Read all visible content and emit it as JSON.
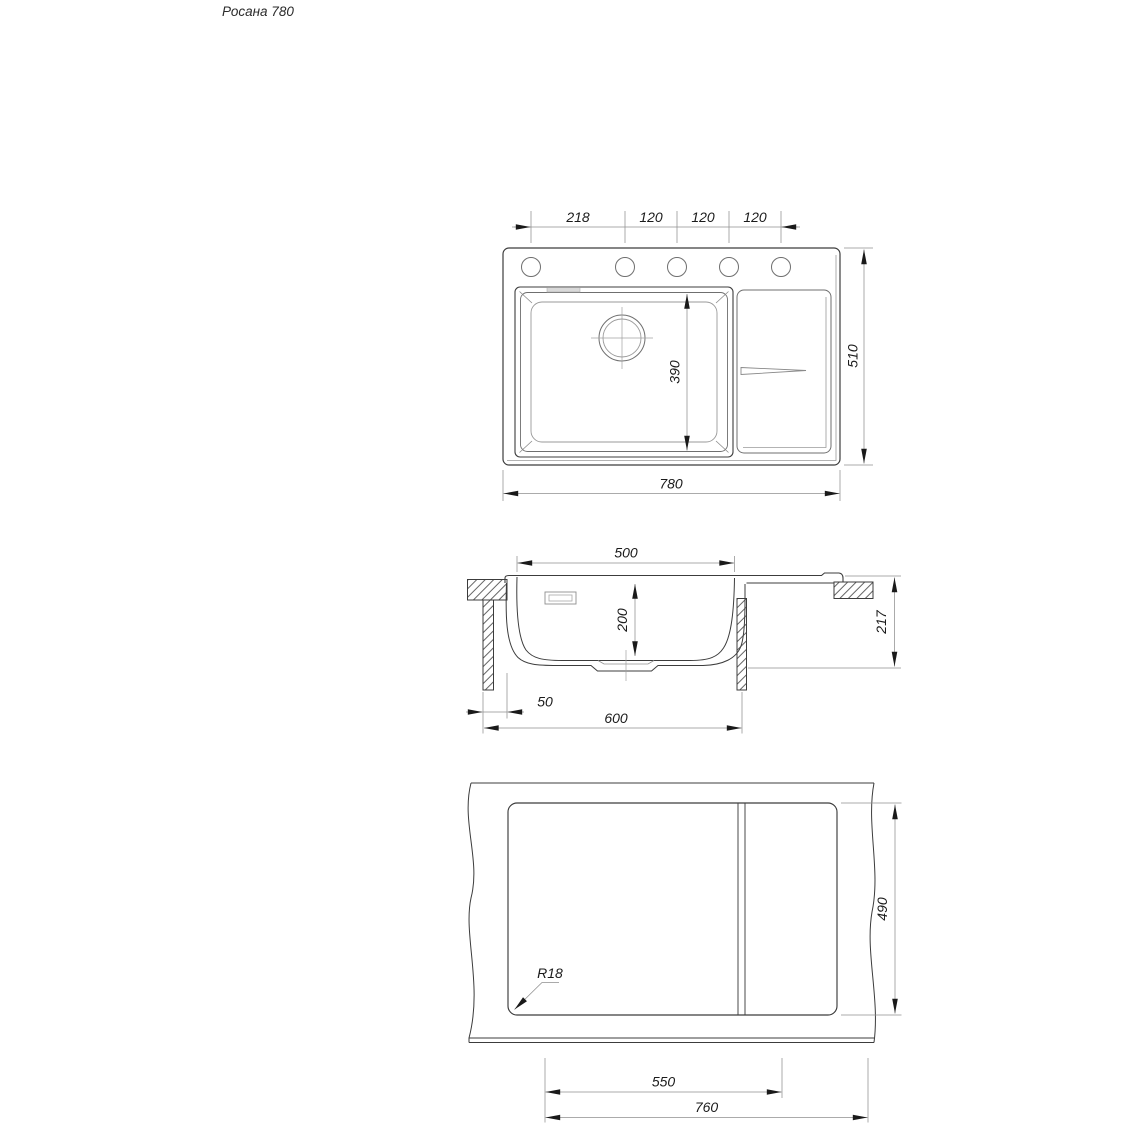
{
  "title": "Росана 780",
  "colors": {
    "main_line": "#3c3c3c",
    "secondary_line": "#6f6f6f",
    "thin_line": "#9a9a9a",
    "dimension_line": "#8f8f8f",
    "text": "#1b1b1b",
    "background": "#ffffff"
  },
  "views": {
    "top": {
      "label": "top-view-plan",
      "d218": "218",
      "d120a": "120",
      "d120b": "120",
      "d120c": "120",
      "d780": "780",
      "d510": "510",
      "d390": "390"
    },
    "section": {
      "label": "section-view",
      "d500": "500",
      "d200": "200",
      "d217": "217",
      "d50": "50",
      "d600": "600"
    },
    "cutout": {
      "label": "countertop-cutout-view",
      "d490": "490",
      "d550": "550",
      "d760": "760",
      "r": "R18"
    }
  }
}
